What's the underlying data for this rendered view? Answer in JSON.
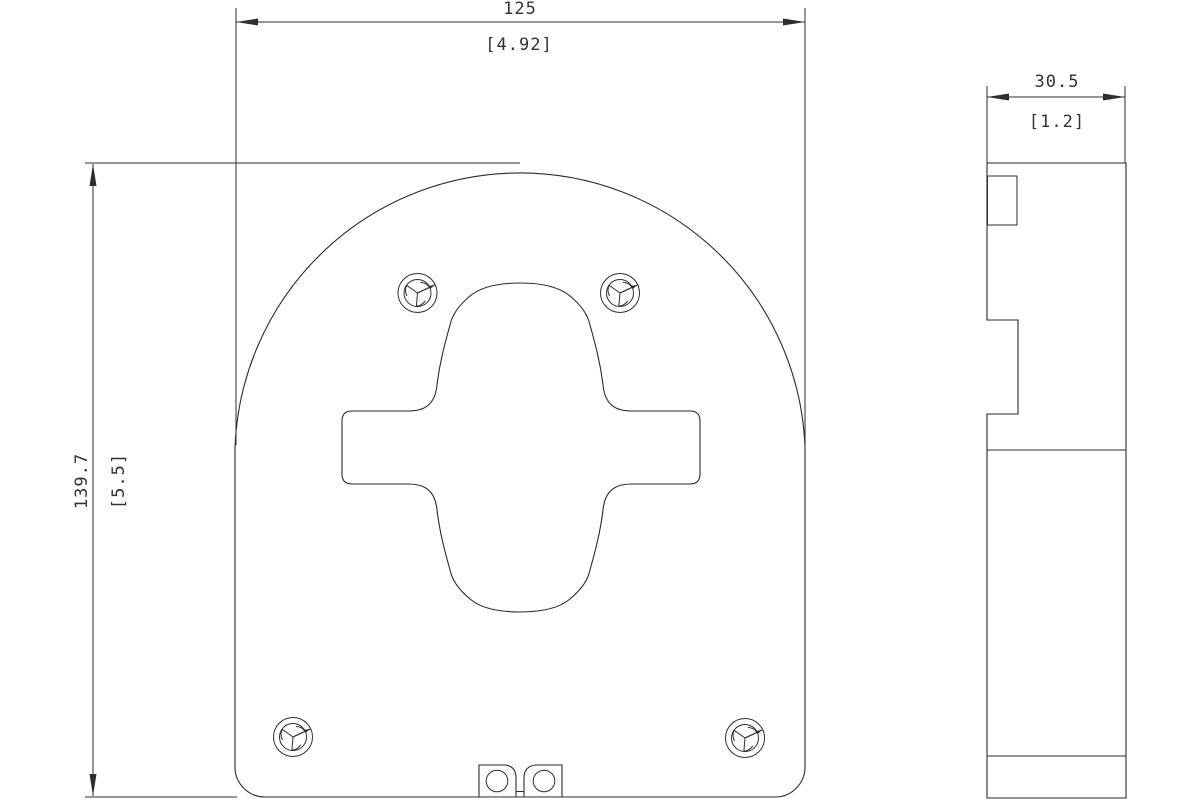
{
  "drawing": {
    "kind": "orthographic-technical-drawing",
    "views": {
      "front_view": {
        "name": "front view of D-shaped mounting plate",
        "width_dim": {
          "primary": "125",
          "secondary": "[4.92]"
        },
        "height_dim": {
          "primary": "139.7",
          "secondary": "[5.5]"
        },
        "features": {
          "screw_count": 4,
          "screw_type": "tri-wing-security-screw",
          "center_cutout": "cross-shaped keyhole cutout with oval lobes",
          "bottom_tab": "cable clamp tab with two holes and center slot"
        }
      },
      "side_view": {
        "name": "right side profile view",
        "depth_dim": {
          "primary": "30.5",
          "secondary": "[1.2]"
        }
      }
    },
    "colors": {
      "line": "#2b2b2b",
      "text": "#333333",
      "background": "#ffffff"
    }
  }
}
